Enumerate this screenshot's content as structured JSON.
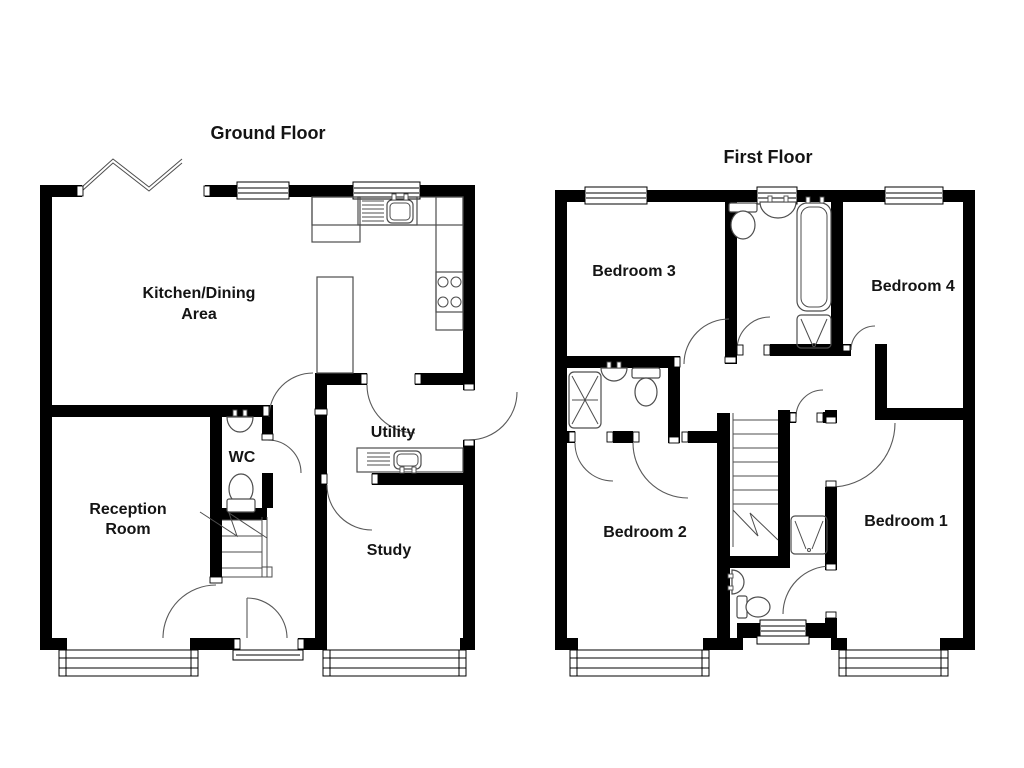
{
  "ground_floor": {
    "title": "Ground Floor",
    "rooms": {
      "kitchen_dining_line1": "Kitchen/Dining",
      "kitchen_dining_line2": "Area",
      "reception_line1": "Reception",
      "reception_line2": "Room",
      "wc": "WC",
      "utility": "Utility",
      "study": "Study"
    }
  },
  "first_floor": {
    "title": "First Floor",
    "rooms": {
      "bedroom1": "Bedroom 1",
      "bedroom2": "Bedroom 2",
      "bedroom3": "Bedroom 3",
      "bedroom4": "Bedroom 4"
    }
  },
  "colors": {
    "wall": "#000000",
    "fixture_line": "#4d4d4d",
    "text": "#141414",
    "background": "#ffffff"
  }
}
